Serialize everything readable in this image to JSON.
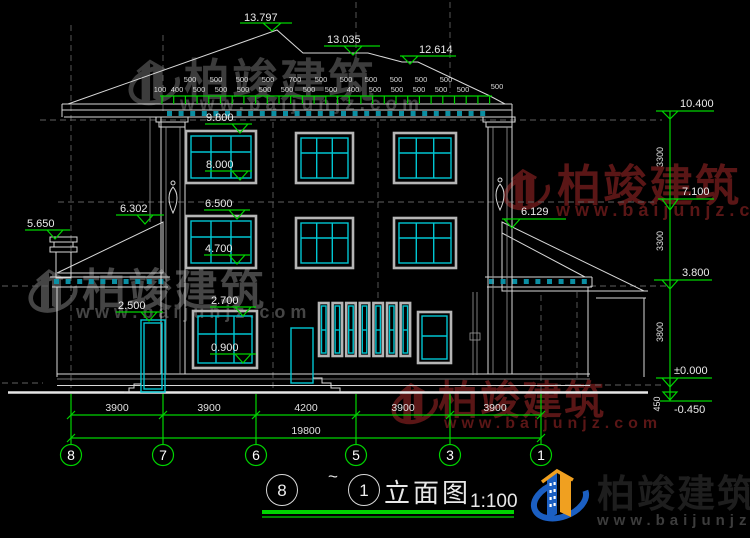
{
  "drawing": {
    "type": "building-elevation",
    "title": {
      "left_bubble": "8",
      "separator": "~",
      "right_bubble": "1",
      "name": "立面图",
      "scale": "1:100"
    }
  },
  "branding": {
    "brand": "柏竣建筑",
    "site": "www.baijunjz.com"
  },
  "colors": {
    "background": "#000000",
    "dim_green": "#00d400",
    "window_cyan": "#00c6d2",
    "dentil_teal": "#0b8fa3",
    "line_white": "#d8d8d8",
    "watermark_gray": "#3f3f3f",
    "watermark_red": "#5a1616",
    "logo_blue": "#1b5fc2",
    "logo_orange": "#f0a020"
  },
  "markers": {
    "ridge": [
      "13.797",
      "13.035",
      "12.614"
    ],
    "left": {
      "chimney": "5.650",
      "left_roof": "6.302"
    },
    "right_wing_roof": "6.129",
    "floors": [
      "9.800",
      "8.000",
      "6.500",
      "4.700",
      "2.700",
      "0.900"
    ],
    "door": "2.500",
    "right_col": [
      "10.400",
      "7.100",
      "3.800",
      "±0.000",
      "-0.450"
    ],
    "right_vdims": [
      "3300",
      "3300",
      "3800",
      "450"
    ]
  },
  "roof_dims": {
    "upper": [
      "500",
      "500",
      "500",
      "500",
      "700",
      "500",
      "500",
      "500",
      "500",
      "500",
      "500"
    ],
    "lower": [
      "100",
      "400",
      "500",
      "500",
      "500",
      "500",
      "500",
      "500",
      "500",
      "400",
      "500",
      "500",
      "500",
      "500",
      "500"
    ],
    "far_right": "500"
  },
  "bottom_dims": {
    "segments": [
      "3900",
      "3900",
      "4200",
      "3900",
      "3900"
    ],
    "total": "19800"
  },
  "grid_bubbles": [
    "8",
    "7",
    "6",
    "5",
    "3",
    "1"
  ]
}
